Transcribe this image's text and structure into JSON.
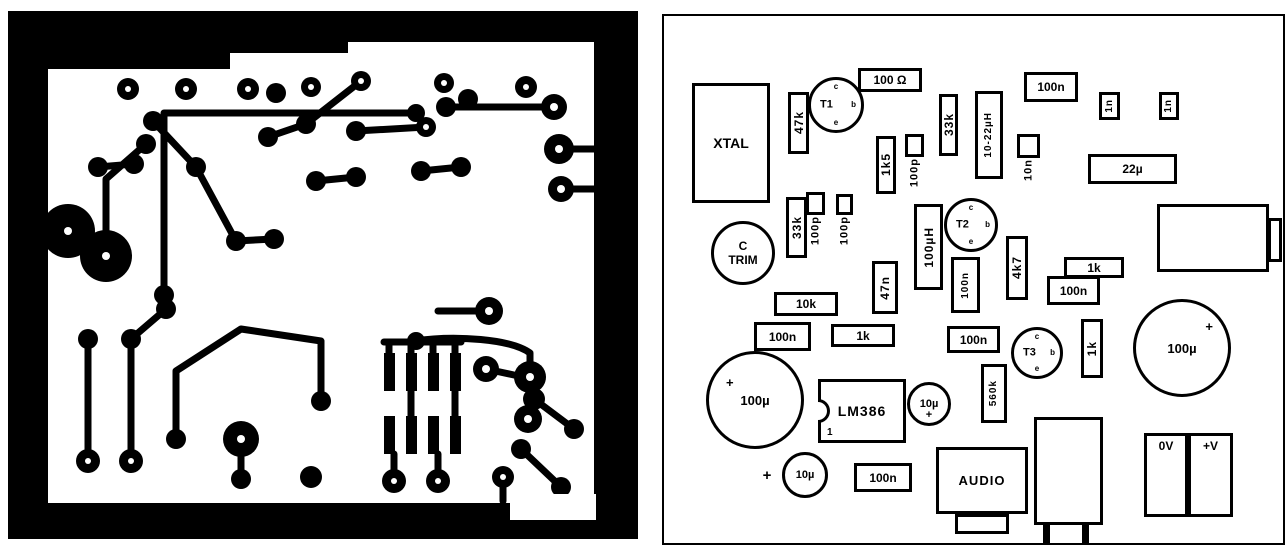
{
  "page": {
    "paper_color": "#ffffff",
    "ink_color": "#000000"
  },
  "pcb_panel": {
    "description_name": "pcb-copper-track-layout"
  },
  "overlay_panel": {
    "description_name": "component-placement-layout"
  },
  "components": [
    {
      "name": "xtal",
      "type": "hrect",
      "label": "XTAL",
      "x": 37,
      "y": 75,
      "w": 78,
      "h": 120,
      "font": 14
    },
    {
      "name": "resistor-47k",
      "type": "vrect",
      "label": "47k",
      "vert": true,
      "x": 133,
      "y": 84,
      "w": 21,
      "h": 62
    },
    {
      "name": "transistor-t1",
      "type": "transistor",
      "label": "T1",
      "x": 153,
      "y": 69,
      "w": 56,
      "h": 56,
      "pins": {
        "top": "c",
        "right": "b",
        "bottom": "e"
      }
    },
    {
      "name": "resistor-100ohm",
      "type": "hrect",
      "label": "100 Ω",
      "x": 203,
      "y": 60,
      "w": 64,
      "h": 24
    },
    {
      "name": "resistor-1k5",
      "type": "vrect",
      "label": "1k5",
      "vert": true,
      "x": 221,
      "y": 128,
      "w": 20,
      "h": 58
    },
    {
      "name": "cap-100p-a",
      "type": "vsquare",
      "sub": "100p",
      "x": 250,
      "y": 126,
      "w": 19,
      "h": 23
    },
    {
      "name": "resistor-33k-top",
      "type": "vrect",
      "label": "33k",
      "vert": true,
      "x": 284,
      "y": 86,
      "w": 19,
      "h": 62
    },
    {
      "name": "inductor-10-22uH",
      "type": "vrect",
      "label": "10-22µH",
      "vert": true,
      "x": 320,
      "y": 83,
      "w": 28,
      "h": 88,
      "font": 10
    },
    {
      "name": "cap-100n-top",
      "type": "hrect",
      "label": "100n",
      "x": 369,
      "y": 64,
      "w": 54,
      "h": 30
    },
    {
      "name": "cap-1n-a",
      "type": "vrect",
      "label": "1n",
      "vert": true,
      "x": 444,
      "y": 84,
      "w": 21,
      "h": 28,
      "font": 10
    },
    {
      "name": "cap-1n-b",
      "type": "vrect",
      "label": "1n",
      "vert": true,
      "x": 504,
      "y": 84,
      "w": 20,
      "h": 28,
      "font": 10
    },
    {
      "name": "cap-10n",
      "type": "vsquare",
      "sub": "10n",
      "x": 362,
      "y": 126,
      "w": 23,
      "h": 24
    },
    {
      "name": "cap-22u",
      "type": "hrect",
      "label": "22µ",
      "x": 433,
      "y": 146,
      "w": 89,
      "h": 30
    },
    {
      "name": "trimmer-c-trim",
      "type": "trimmer",
      "label_lines": [
        "C",
        "TRIM"
      ],
      "x": 56,
      "y": 213,
      "w": 64,
      "h": 64
    },
    {
      "name": "resistor-33k-mid",
      "type": "vrect",
      "label": "33k",
      "vert": true,
      "x": 131,
      "y": 189,
      "w": 21,
      "h": 61
    },
    {
      "name": "cap-100p-b",
      "type": "vsquare",
      "sub": "100p",
      "x": 151,
      "y": 184,
      "w": 19,
      "h": 23
    },
    {
      "name": "cap-100p-c",
      "type": "vsquare",
      "sub": "100p",
      "x": 181,
      "y": 186,
      "w": 17,
      "h": 21
    },
    {
      "name": "inductor-100uH",
      "type": "vrect",
      "label": "100µH",
      "vert": true,
      "x": 259,
      "y": 196,
      "w": 29,
      "h": 86
    },
    {
      "name": "transistor-t2",
      "type": "transistor",
      "label": "T2",
      "x": 289,
      "y": 190,
      "w": 54,
      "h": 54,
      "pins": {
        "top": "c",
        "right": "b",
        "bottom": "e"
      }
    },
    {
      "name": "cap-47n",
      "type": "vrect",
      "label": "47n",
      "vert": true,
      "x": 217,
      "y": 253,
      "w": 26,
      "h": 53
    },
    {
      "name": "cap-100n-t2",
      "type": "vrect",
      "label": "100n",
      "vert": true,
      "x": 296,
      "y": 249,
      "w": 29,
      "h": 56,
      "font": 10
    },
    {
      "name": "resistor-4k7",
      "type": "vrect",
      "label": "4k7",
      "vert": true,
      "x": 351,
      "y": 228,
      "w": 22,
      "h": 64
    },
    {
      "name": "resistor-1k-right",
      "type": "hrect",
      "label": "1k",
      "x": 409,
      "y": 249,
      "w": 60,
      "h": 21
    },
    {
      "name": "cap-100n-right",
      "type": "hrect",
      "label": "100n",
      "x": 392,
      "y": 268,
      "w": 53,
      "h": 29
    },
    {
      "name": "phones-connector",
      "type": "connector",
      "label": "",
      "x": 502,
      "y": 196,
      "w": 112,
      "h": 68,
      "tabs": [
        {
          "x": 108,
          "y": 11,
          "w": 14,
          "h": 44
        }
      ]
    },
    {
      "name": "resistor-10k",
      "type": "hrect",
      "label": "10k",
      "x": 119,
      "y": 284,
      "w": 64,
      "h": 24
    },
    {
      "name": "cap-100n-left",
      "type": "hrect",
      "label": "100n",
      "x": 99,
      "y": 314,
      "w": 57,
      "h": 29
    },
    {
      "name": "resistor-1k-mid",
      "type": "hrect",
      "label": "1k",
      "x": 176,
      "y": 316,
      "w": 64,
      "h": 23
    },
    {
      "name": "cap-100n-t3",
      "type": "hrect",
      "label": "100n",
      "x": 292,
      "y": 318,
      "w": 53,
      "h": 27
    },
    {
      "name": "transistor-t3",
      "type": "transistor",
      "label": "T3",
      "x": 356,
      "y": 319,
      "w": 52,
      "h": 52,
      "pins": {
        "top": "c",
        "right": "b",
        "bottom": "e"
      }
    },
    {
      "name": "resistor-1k-vert",
      "type": "vrect",
      "label": "1k",
      "vert": true,
      "x": 426,
      "y": 311,
      "w": 22,
      "h": 59
    },
    {
      "name": "cap-100u-right",
      "type": "bigcap",
      "label": "100µ",
      "plus": "tr",
      "x": 478,
      "y": 291,
      "w": 98,
      "h": 98
    },
    {
      "name": "resistor-560k",
      "type": "vrect",
      "label": "560k",
      "vert": true,
      "x": 326,
      "y": 356,
      "w": 26,
      "h": 59,
      "font": 10
    },
    {
      "name": "cap-100u-left",
      "type": "bigcap",
      "label": "100µ",
      "plus": "tl",
      "x": 51,
      "y": 343,
      "w": 98,
      "h": 98
    },
    {
      "name": "ic-lm386",
      "type": "ic",
      "label": "LM386",
      "notch": true,
      "pin1": "1",
      "x": 163,
      "y": 371,
      "w": 88,
      "h": 64
    },
    {
      "name": "cap-10u-a",
      "type": "capcircle",
      "label": "10µ",
      "plus": "bottom",
      "x": 252,
      "y": 374,
      "w": 44,
      "h": 44,
      "font": 11
    },
    {
      "name": "cap-10u-b",
      "type": "capcircle",
      "label": "10µ",
      "x": 127,
      "y": 444,
      "w": 46,
      "h": 46,
      "font": 11
    },
    {
      "name": "plus-mark-10u-b",
      "type": "mark",
      "label": "+",
      "x": 104,
      "y": 459,
      "w": 16,
      "h": 16
    },
    {
      "name": "cap-100n-bottom",
      "type": "hrect",
      "label": "100n",
      "x": 199,
      "y": 455,
      "w": 58,
      "h": 29
    },
    {
      "name": "audio-connector",
      "type": "connector",
      "label": "AUDIO",
      "x": 281,
      "y": 439,
      "w": 92,
      "h": 67,
      "tabs": [
        {
          "x": 16,
          "y": 64,
          "w": 54,
          "h": 20
        }
      ]
    },
    {
      "name": "unlabeled-connector",
      "type": "connector",
      "label": "",
      "x": 379,
      "y": 409,
      "w": 69,
      "h": 108,
      "tabs": [
        {
          "x": 6,
          "y": 105,
          "w": 7,
          "h": 19,
          "solid": true
        },
        {
          "x": 45,
          "y": 105,
          "w": 7,
          "h": 19,
          "solid": true
        }
      ]
    },
    {
      "name": "terminal-0v",
      "type": "terminal",
      "label": "0V",
      "x": 489,
      "y": 425,
      "w": 44,
      "h": 84
    },
    {
      "name": "terminal-plus-v",
      "type": "terminal",
      "label": "+V",
      "x": 533,
      "y": 425,
      "w": 45,
      "h": 84
    }
  ]
}
